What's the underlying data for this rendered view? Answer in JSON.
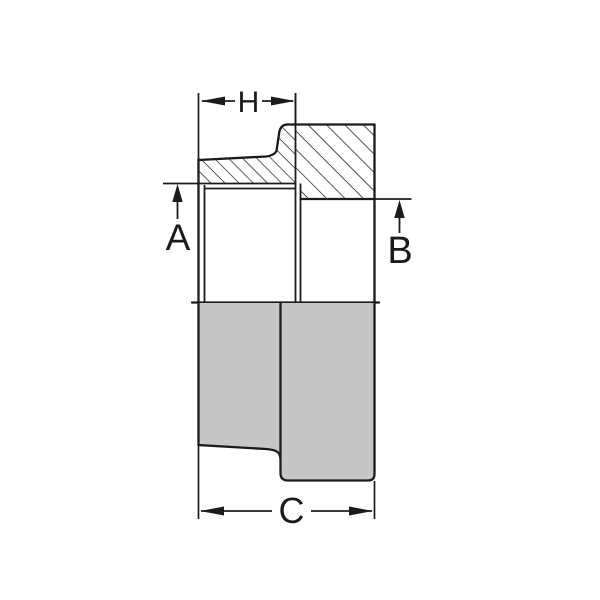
{
  "diagram": {
    "kind": "engineering half-section drawing of a tapered pipe fitting",
    "colors": {
      "background": "#ffffff",
      "line": "#1b1b1b",
      "section_fill": "#c6c6c7"
    },
    "dimensions": {
      "top_width": {
        "label": "H"
      },
      "left_diameter": {
        "label": "A"
      },
      "right_diameter": {
        "label": "B"
      },
      "overall_length": {
        "label": "C"
      }
    }
  }
}
